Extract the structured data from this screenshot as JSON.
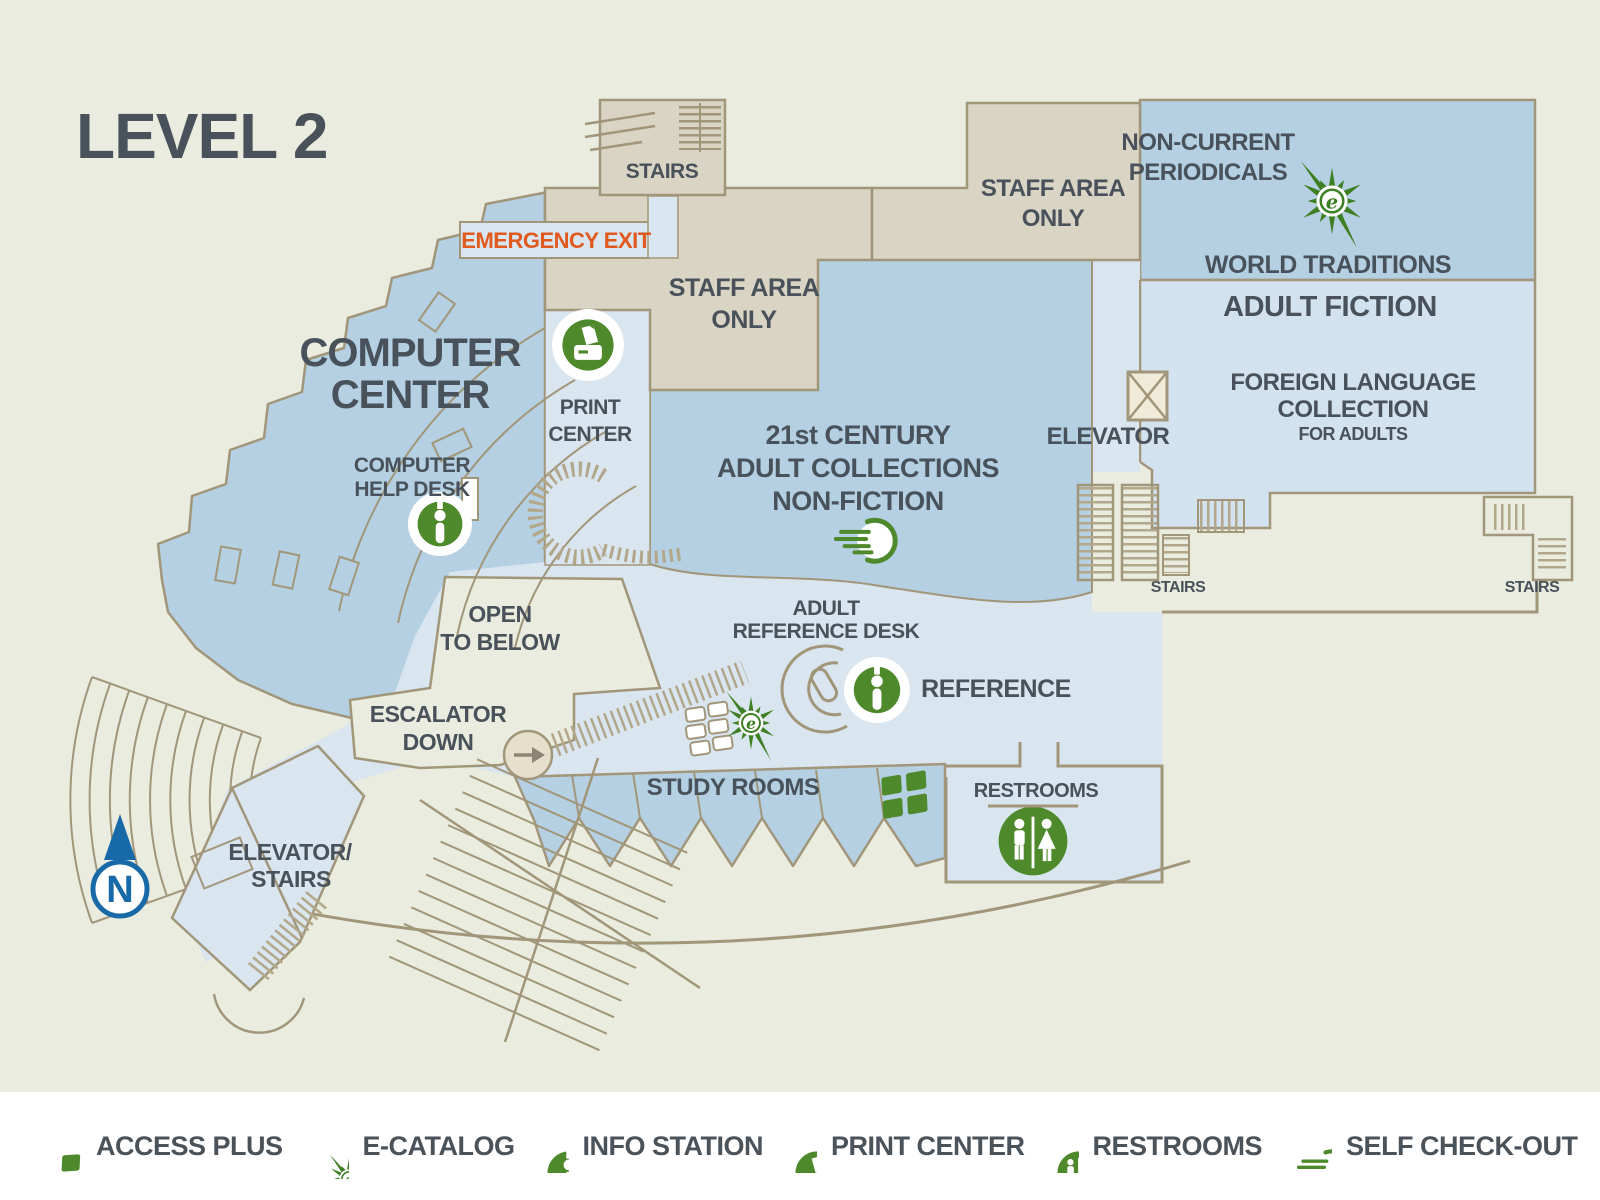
{
  "title": "LEVEL 2",
  "colors": {
    "background_sage": "#e9ecdf",
    "room_tan": "#d9d4c4",
    "wall_brown": "#a2967a",
    "blue_medium": "#b4d0e2",
    "blue_light": "#d9e5ef",
    "icon_green": "#4e8a2b",
    "title_blue": "#1769a8",
    "emergency_orange": "#e05a20",
    "label_gray": "#49525a",
    "legend_white": "#ffffff"
  },
  "map": {
    "rooms": {
      "stairs_top": "STAIRS",
      "emergency_exit": "EMERGENCY EXIT",
      "staff_area_center": {
        "line1": "STAFF AREA",
        "line2": "ONLY"
      },
      "staff_area_right": {
        "line1": "STAFF AREA",
        "line2": "ONLY"
      },
      "computer_center": {
        "line1": "COMPUTER",
        "line2": "CENTER"
      },
      "print_center": {
        "line1": "PRINT",
        "line2": "CENTER"
      },
      "computer_help_desk": {
        "line1": "COMPUTER",
        "line2": "HELP DESK"
      },
      "adult_collections": {
        "line1": "21st CENTURY",
        "line2": "ADULT COLLECTIONS",
        "line3": "NON-FICTION"
      },
      "non_current_periodicals": {
        "line1": "NON-CURRENT",
        "line2": "PERIODICALS"
      },
      "world_traditions": "WORLD TRADITIONS",
      "adult_fiction": "ADULT FICTION",
      "foreign_language": {
        "line1": "FOREIGN LANGUAGE",
        "line2": "COLLECTION",
        "line3": "FOR ADULTS"
      },
      "elevator": "ELEVATOR",
      "stairs_center": "STAIRS",
      "stairs_right": "STAIRS",
      "open_to_below": {
        "line1": "OPEN",
        "line2": "TO BELOW"
      },
      "adult_reference_desk": {
        "line1": "ADULT",
        "line2": "REFERENCE DESK"
      },
      "reference": "REFERENCE",
      "escalator_down": {
        "line1": "ESCALATOR",
        "line2": "DOWN"
      },
      "study_rooms": "STUDY ROOMS",
      "restrooms": "RESTROOMS",
      "elevator_stairs": {
        "line1": "ELEVATOR/",
        "line2": "STAIRS"
      }
    },
    "compass": {
      "letter": "N"
    }
  },
  "legend": {
    "items": [
      {
        "icon": "access-plus-icon",
        "label": "ACCESS PLUS"
      },
      {
        "icon": "e-catalog-icon",
        "label": "E-CATALOG"
      },
      {
        "icon": "info-station-icon",
        "label": "INFO STATION"
      },
      {
        "icon": "print-center-icon",
        "label": "PRINT CENTER"
      },
      {
        "icon": "restrooms-icon",
        "label": "RESTROOMS"
      },
      {
        "icon": "self-checkout-icon",
        "label": "SELF CHECK-OUT"
      }
    ]
  }
}
